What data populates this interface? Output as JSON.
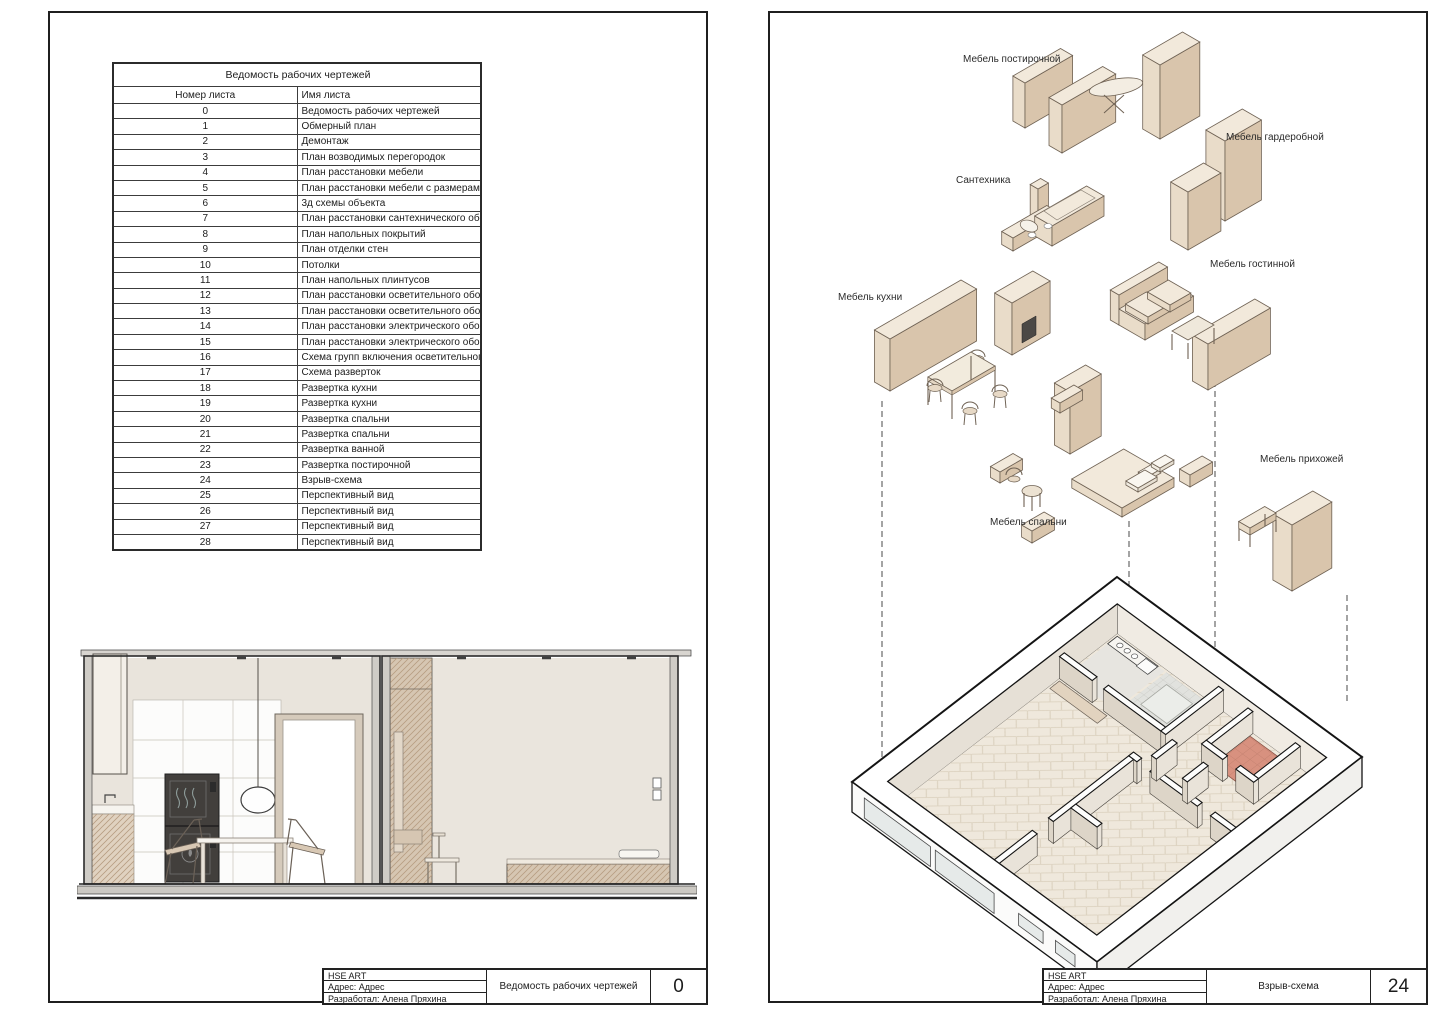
{
  "sheet_left": {
    "table": {
      "title": "Ведомость рабочих чертежей",
      "header_number": "Номер листа",
      "header_name": "Имя листа",
      "rows": [
        {
          "num": "0",
          "name": "Ведомость рабочих чертежей"
        },
        {
          "num": "1",
          "name": "Обмерный план"
        },
        {
          "num": "2",
          "name": "Демонтаж"
        },
        {
          "num": "3",
          "name": "План возводимых перегородок"
        },
        {
          "num": "4",
          "name": "План расстановки мебели"
        },
        {
          "num": "5",
          "name": "План расстановки мебели с размерами"
        },
        {
          "num": "6",
          "name": "3д схемы объекта"
        },
        {
          "num": "7",
          "name": "План расстановки сантехнического оборудования"
        },
        {
          "num": "8",
          "name": "План напольных покрытий"
        },
        {
          "num": "9",
          "name": "План отделки стен"
        },
        {
          "num": "10",
          "name": "Потолки"
        },
        {
          "num": "11",
          "name": "План напольных плинтусов"
        },
        {
          "num": "12",
          "name": "План расстановки осветительного оборудования"
        },
        {
          "num": "13",
          "name": "План расстановки осветительного оборудования с размерами"
        },
        {
          "num": "14",
          "name": "План расстановки электрического оборудования"
        },
        {
          "num": "15",
          "name": "План расстановки электрического оборудования с размерами"
        },
        {
          "num": "16",
          "name": "Схема групп включения осветительного оборудования"
        },
        {
          "num": "17",
          "name": "Схема разверток"
        },
        {
          "num": "18",
          "name": "Развертка кухни"
        },
        {
          "num": "19",
          "name": "Развертка кухни"
        },
        {
          "num": "20",
          "name": "Развертка спальни"
        },
        {
          "num": "21",
          "name": "Развертка спальни"
        },
        {
          "num": "22",
          "name": "Развертка ванной"
        },
        {
          "num": "23",
          "name": "Развертка постирочной"
        },
        {
          "num": "24",
          "name": "Взрыв-схема"
        },
        {
          "num": "25",
          "name": "Перспективный вид"
        },
        {
          "num": "26",
          "name": "Перспективный вид"
        },
        {
          "num": "27",
          "name": "Перспективный вид"
        },
        {
          "num": "28",
          "name": "Перспективный вид"
        }
      ]
    },
    "title_block": {
      "org": "HSE ART",
      "address": "Адрес:  Адрес",
      "author": "Разработал: Алена Пряхина",
      "sheet_name": "Ведомость рабочих чертежей",
      "sheet_number": "0"
    }
  },
  "sheet_right": {
    "labels": {
      "laundry": "Мебель постирочной",
      "wardrobe": "Мебель гардеробной",
      "plumbing": "Сантехника",
      "living": "Мебель гостинной",
      "kitchen": "Мебель кухни",
      "hallway": "Мебель прихожей",
      "bedroom": "Мебель спальни"
    },
    "title_block": {
      "org": "HSE ART",
      "address": "Адрес:  Адрес",
      "author": "Разработал: Алена Пряхина",
      "sheet_name": "Взрыв-схема",
      "sheet_number": "24"
    }
  },
  "colors": {
    "line": "#1f1f1f",
    "furniture_top": "#f2e9db",
    "furniture_front": "#e9dcc9",
    "furniture_side": "#d9c5ac",
    "floor_parquet": "#efe8dc",
    "red_tile": "#d8917f",
    "hatch": "#b79d82",
    "wall_fill": "#e9e4dc"
  }
}
